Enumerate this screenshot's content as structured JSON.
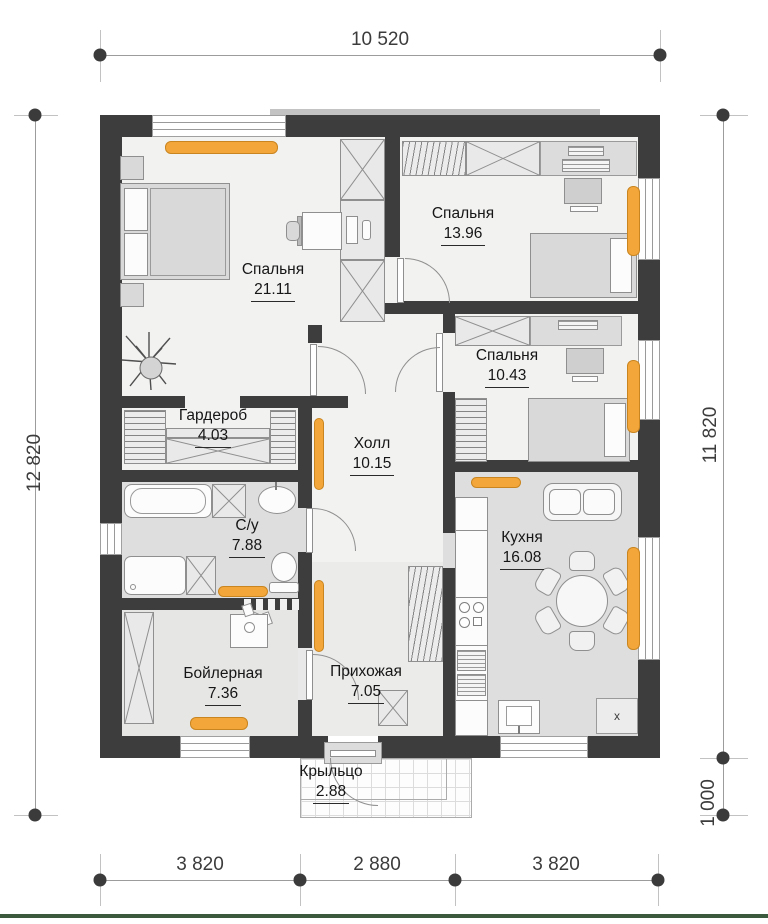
{
  "plan": {
    "rooms": [
      {
        "id": "bedroom-1",
        "name": "Спальня",
        "area": "21.11"
      },
      {
        "id": "bedroom-2",
        "name": "Спальня",
        "area": "13.96"
      },
      {
        "id": "bedroom-3",
        "name": "Спальня",
        "area": "10.43"
      },
      {
        "id": "wardrobe-room",
        "name": "Гардероб",
        "area": "4.03"
      },
      {
        "id": "hall",
        "name": "Холл",
        "area": "10.15"
      },
      {
        "id": "bathroom",
        "name": "С/у",
        "area": "7.88"
      },
      {
        "id": "entry-hall",
        "name": "Прихожая",
        "area": "7.05"
      },
      {
        "id": "boiler-room",
        "name": "Бойлерная",
        "area": "7.36"
      },
      {
        "id": "kitchen",
        "name": "Кухня",
        "area": "16.08"
      },
      {
        "id": "porch",
        "name": "Крыльцо",
        "area": "2.88"
      }
    ],
    "dimensions": {
      "top": "10 520",
      "left": "12 820",
      "right_upper": "11 820",
      "right_lower": "1 000",
      "bottom": [
        "3 820",
        "2 880",
        "3 820"
      ]
    },
    "kitchen_marker": "x",
    "colors": {
      "wall": "#3d3d3d",
      "radiator": "#f3a63a",
      "floor_light": "#f2f2f1",
      "floor_gray": "#dedede",
      "furniture": "#d9d9d9",
      "bottom_accent_line": "#3b5a3d"
    }
  }
}
